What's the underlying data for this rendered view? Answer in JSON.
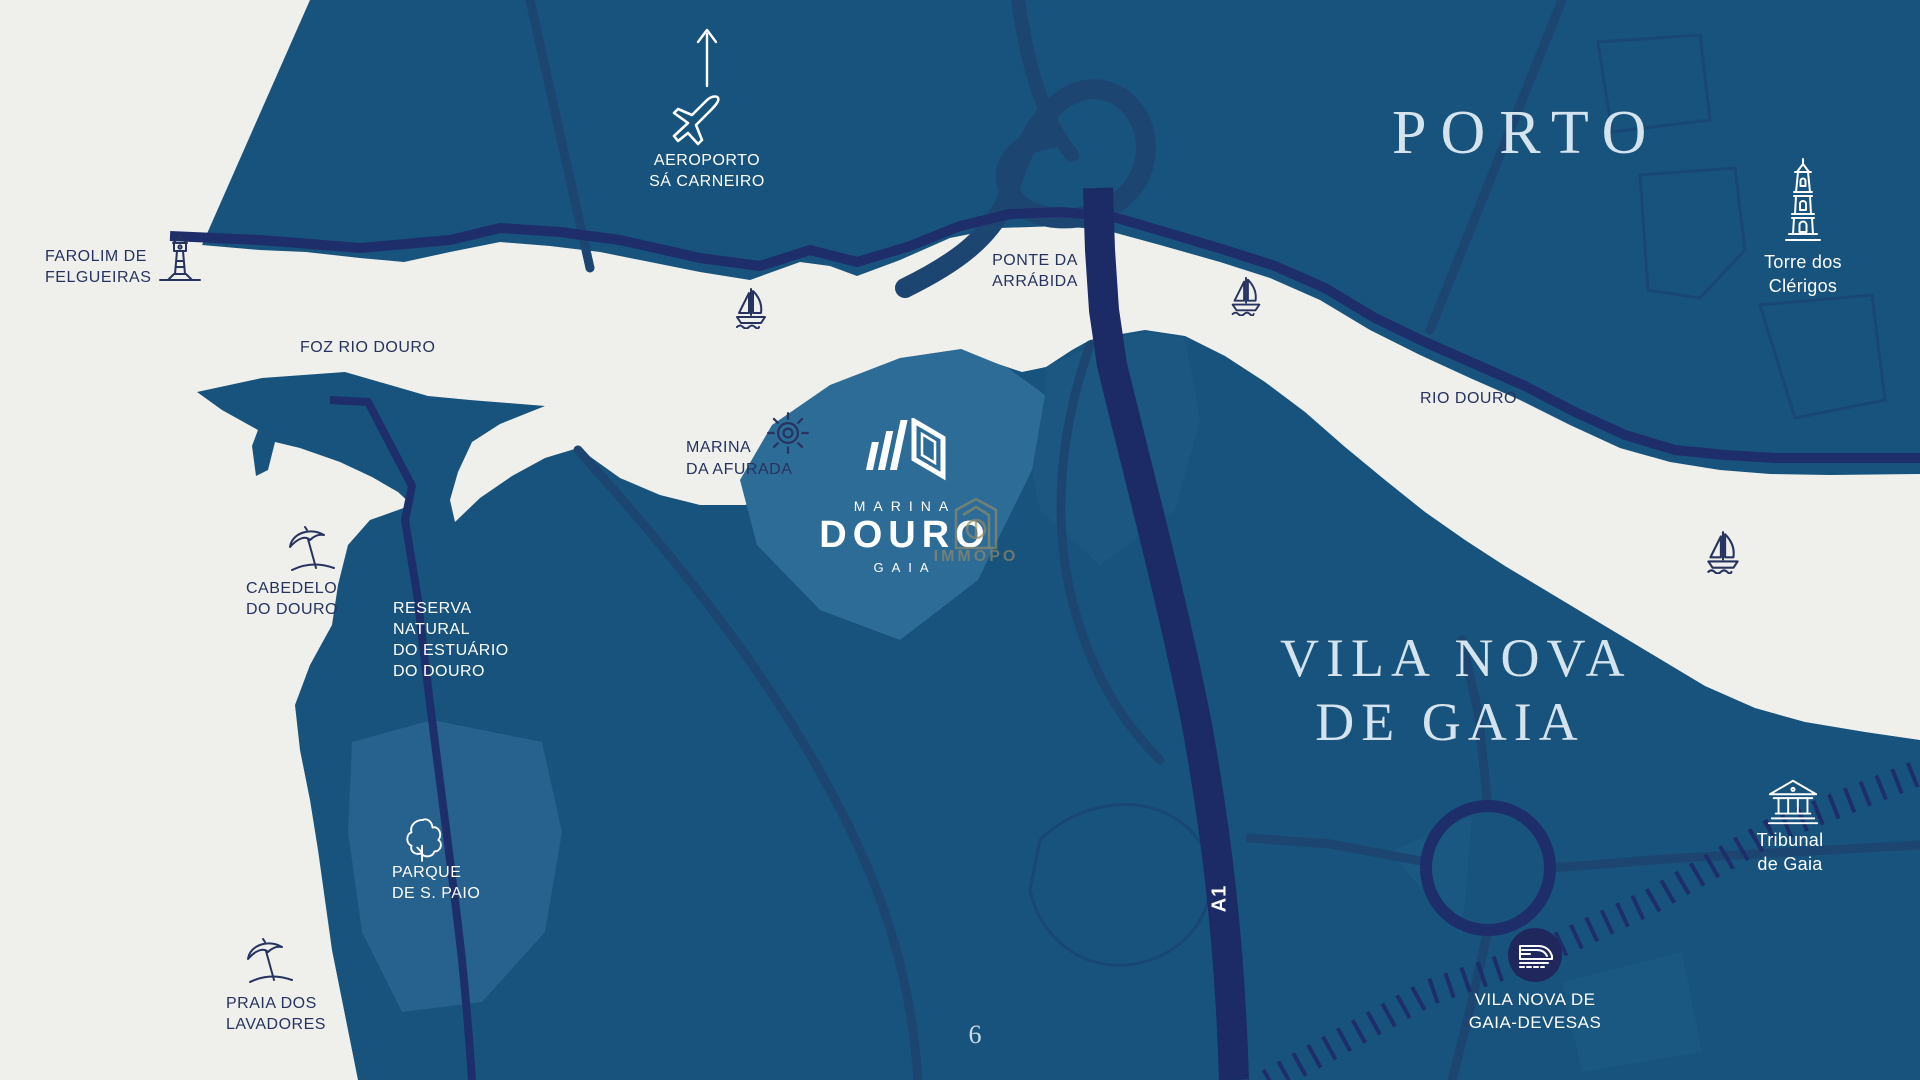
{
  "map": {
    "page_number": "6",
    "colors": {
      "water": "#EFEFEC",
      "land": "#17537C",
      "land_highlight": "#2E6C98",
      "park_patch": "#27618D",
      "road_subtle": "#1D4571",
      "highway_navy": "#1C2A66",
      "shore_road_navy": "#1E2E6B",
      "station_circle": "#20275C",
      "label_dark": "#27335F",
      "label_light": "#FFFFFF",
      "city_serif_light": "#D5E3EE",
      "watermark_gold": "#928A66"
    }
  },
  "regions": {
    "porto": {
      "label": "PORTO"
    },
    "vila_nova": {
      "line1": "VILA NOVA",
      "line2": "DE GAIA"
    }
  },
  "pois": {
    "aeroporto": {
      "line1": "AEROPORTO",
      "line2": "SÁ CARNEIRO",
      "icon": "airplane-icon"
    },
    "farolim": {
      "line1": "FAROLIM DE",
      "line2": "FELGUEIRAS",
      "icon": "lighthouse-icon"
    },
    "foz": {
      "label": "FOZ RIO DOURO"
    },
    "ponte": {
      "line1": "PONTE DA",
      "line2": "ARRÁBIDA"
    },
    "rio_douro": {
      "label": "RIO DOURO"
    },
    "torre": {
      "line1": "Torre dos",
      "line2": "Clérigos",
      "icon": "tower-icon"
    },
    "marina_afurada": {
      "line1": "MARINA",
      "line2": "DA AFURADA",
      "icon": "ship-wheel-icon"
    },
    "cabedelo": {
      "line1": "CABEDELO",
      "line2": "DO DOURO",
      "icon": "beach-umbrella-icon"
    },
    "reserva": {
      "line1": "RESERVA",
      "line2": "NATURAL",
      "line3": "DO ESTUÁRIO",
      "line4": "DO DOURO"
    },
    "parque": {
      "line1": "PARQUE",
      "line2": "DE S. PAIO",
      "icon": "tree-icon"
    },
    "praia": {
      "line1": "PRAIA DOS",
      "line2": "LAVADORES",
      "icon": "beach-umbrella-icon"
    },
    "tribunal": {
      "line1": "Tribunal",
      "line2": "de Gaia",
      "icon": "courthouse-icon"
    },
    "devesas": {
      "line1": "VILA NOVA DE",
      "line2": "GAIA-DEVESAS",
      "icon": "train-icon"
    },
    "a1": {
      "label": "A1"
    }
  },
  "logo": {
    "brand_top": "MARINA",
    "brand_main": "DOURO",
    "brand_sub": "GAIA",
    "watermark": "IMMOPO"
  }
}
